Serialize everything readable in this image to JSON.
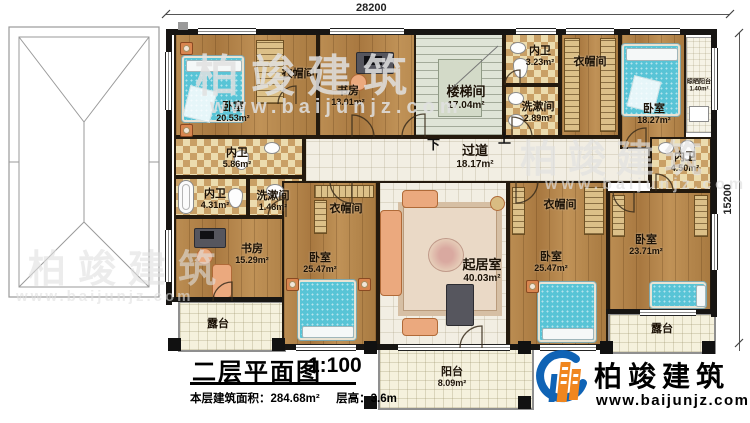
{
  "dimensions": {
    "top": "28200",
    "right": "15200"
  },
  "stairs": {
    "down": "下",
    "up": "上"
  },
  "rooms": {
    "bedroom_tl": {
      "label": "卧室",
      "area": "20.53m²"
    },
    "closet_tl": {
      "label": "衣帽间"
    },
    "study_tl": {
      "label": "书房",
      "area": "13.01m²"
    },
    "stairwell": {
      "label": "楼梯间",
      "area": "17.04m²"
    },
    "bath_top": {
      "label": "内卫",
      "area": "3.23m²"
    },
    "wash_top": {
      "label": "洗漱间",
      "area": "2.89m²"
    },
    "closet_tr": {
      "label": "衣帽间"
    },
    "bedroom_tr": {
      "label": "卧室",
      "area": "18.27m²"
    },
    "drying_balcony": {
      "label": "晾晒阳台",
      "area": "1.40m²"
    },
    "bath_left_upper": {
      "label": "内卫",
      "area": "5.86m²"
    },
    "bath_left_lower": {
      "label": "内卫",
      "area": "4.31m²"
    },
    "wash_left": {
      "label": "洗漱间",
      "area": "1.48m²"
    },
    "study_left": {
      "label": "书房",
      "area": "15.29m²"
    },
    "corridor": {
      "label": "过道",
      "area": "18.17m²"
    },
    "living": {
      "label": "起居室",
      "area": "40.03m²"
    },
    "closet_mid": {
      "label": "衣帽间"
    },
    "bedroom_bl": {
      "label": "卧室",
      "area": "25.47m²"
    },
    "closet_right": {
      "label": "衣帽间"
    },
    "bedroom_mr": {
      "label": "卧室",
      "area": "25.47m²"
    },
    "bedroom_br": {
      "label": "卧室",
      "area": "23.71m²"
    },
    "bath_right": {
      "label": "内卫",
      "area": "4.50m²"
    },
    "terrace_left": {
      "label": "露台"
    },
    "terrace_right": {
      "label": "露台"
    },
    "balcony": {
      "label": "阳台",
      "area": "8.09m²"
    }
  },
  "title": {
    "text": "二层平面图",
    "scale": "1:100",
    "area_label": "本层建筑面积：",
    "area_value": "284.68m²",
    "floor_height_label": "层高：",
    "floor_height_value": "3.6m"
  },
  "logo": {
    "name": "柏竣建筑",
    "url": "www.baijunjz.com"
  },
  "watermark": {
    "name": "柏竣建筑",
    "url": "www.baijunjz.com"
  }
}
